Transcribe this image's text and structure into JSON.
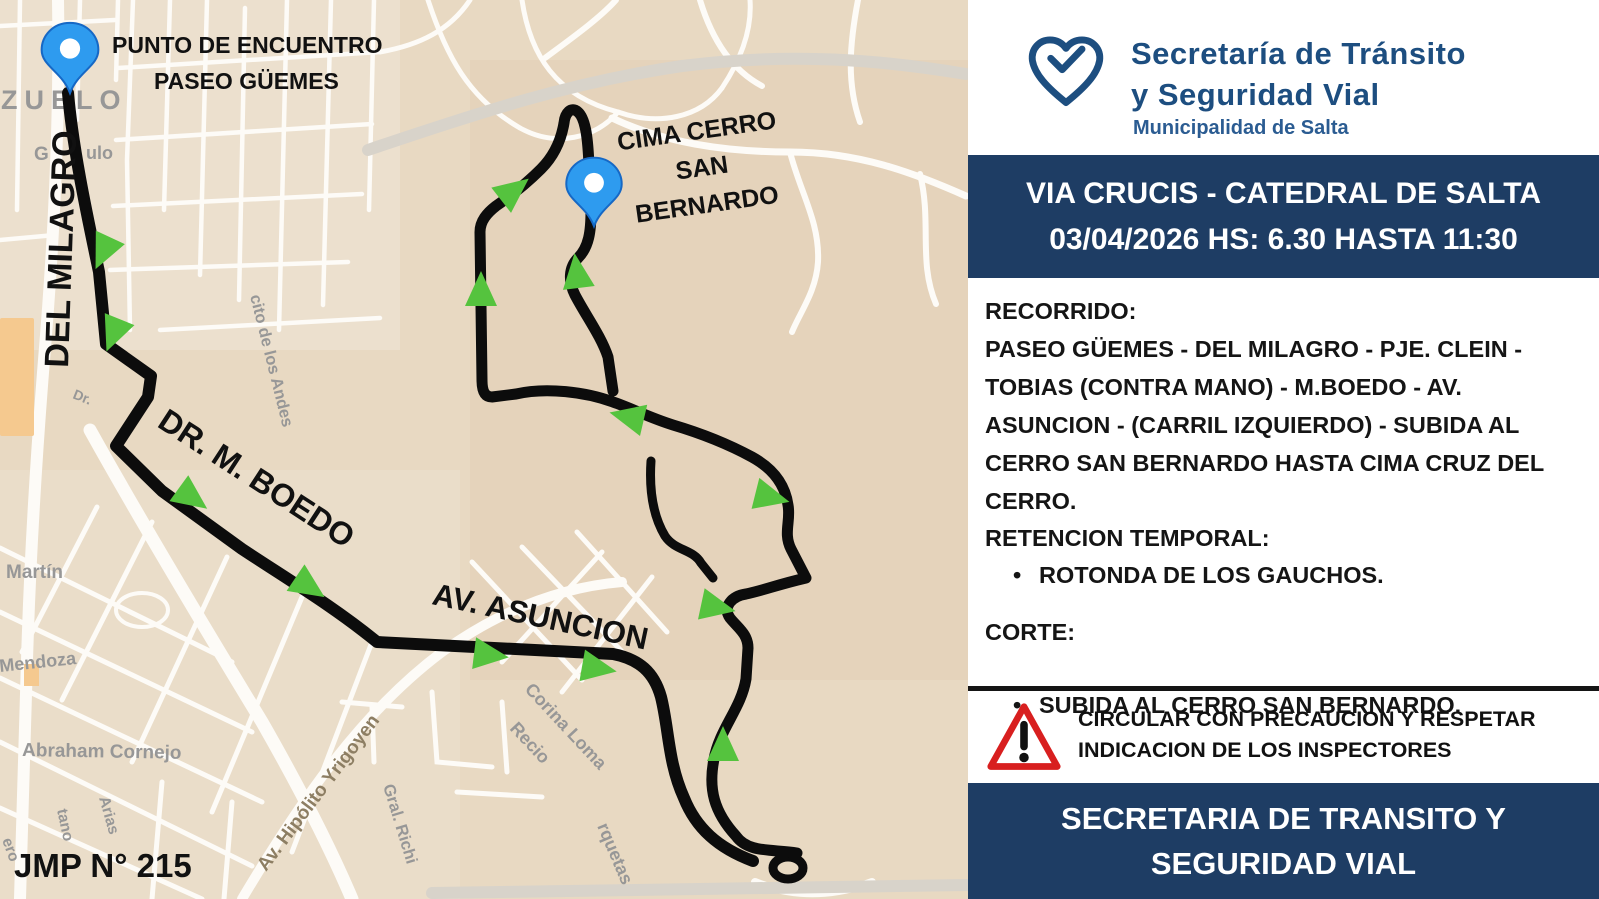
{
  "colors": {
    "navy": "#1e3d64",
    "logo_blue": "#1d4e80",
    "arrow_green": "#55c33e",
    "pin_blue": "#2e9bef",
    "warning_red": "#d81f1f",
    "map_beige": "#e8d9c2",
    "route_black": "#0c0c0c"
  },
  "map": {
    "meeting_point": {
      "line1": "PUNTO DE ENCUENTRO",
      "line2": "PASEO GÜEMES"
    },
    "cima": {
      "line1": "CIMA CERRO",
      "line2": "SAN",
      "line3": "BERNARDO"
    },
    "route_streets": {
      "del_milagro": "DEL MILAGRO",
      "boedo": "DR. M. BOEDO",
      "asuncion": "AV. ASUNCION"
    },
    "ref_code": "JMP N° 215",
    "streets": {
      "zuelo": "ZUELO",
      "frag_g": "G",
      "frag_ulo": "ulo",
      "dr": "Dr.",
      "andes": "cito de los Andes",
      "martin": "Martín",
      "mendoza": "Mendoza",
      "cornejo": "Abraham Cornejo",
      "yrigoyen": "Av. Hipólito Yrigoyen",
      "richieri": "Gral. Richi",
      "corina": "Corina Loma",
      "recio": "Recio",
      "horquetas": "rquetas",
      "tano": "tano",
      "arias": "Arias",
      "ero": "ero"
    }
  },
  "panel": {
    "logo": {
      "line1": "Secretaría de Tránsito",
      "line2": "y Seguridad Vial",
      "line3": "Municipalidad de Salta"
    },
    "banner": {
      "line1": "VIA CRUCIS - CATEDRAL DE SALTA",
      "line2": "03/04/2026 HS: 6.30 HASTA 11:30"
    },
    "recorrido": {
      "heading": "RECORRIDO:",
      "lines": [
        "PASEO GÜEMES - DEL MILAGRO - PJE. CLEIN -",
        "TOBIAS (CONTRA MANO) - M.BOEDO - AV.",
        "ASUNCION - (CARRIL IZQUIERDO) - SUBIDA AL",
        "CERRO SAN BERNARDO HASTA CIMA CRUZ DEL",
        "CERRO."
      ]
    },
    "retencion": {
      "heading": "RETENCION TEMPORAL:",
      "item": "ROTONDA DE LOS GAUCHOS."
    },
    "corte": {
      "heading": "CORTE:",
      "item": "SUBIDA AL CERRO SAN BERNARDO."
    },
    "warning": {
      "line1": "CIRCULAR CON PRECAUCION Y RESPETAR",
      "line2": "INDICACION DE LOS INSPECTORES"
    },
    "footer": {
      "line1": "SECRETARIA DE TRANSITO Y",
      "line2": "SEGURIDAD VIAL"
    }
  }
}
